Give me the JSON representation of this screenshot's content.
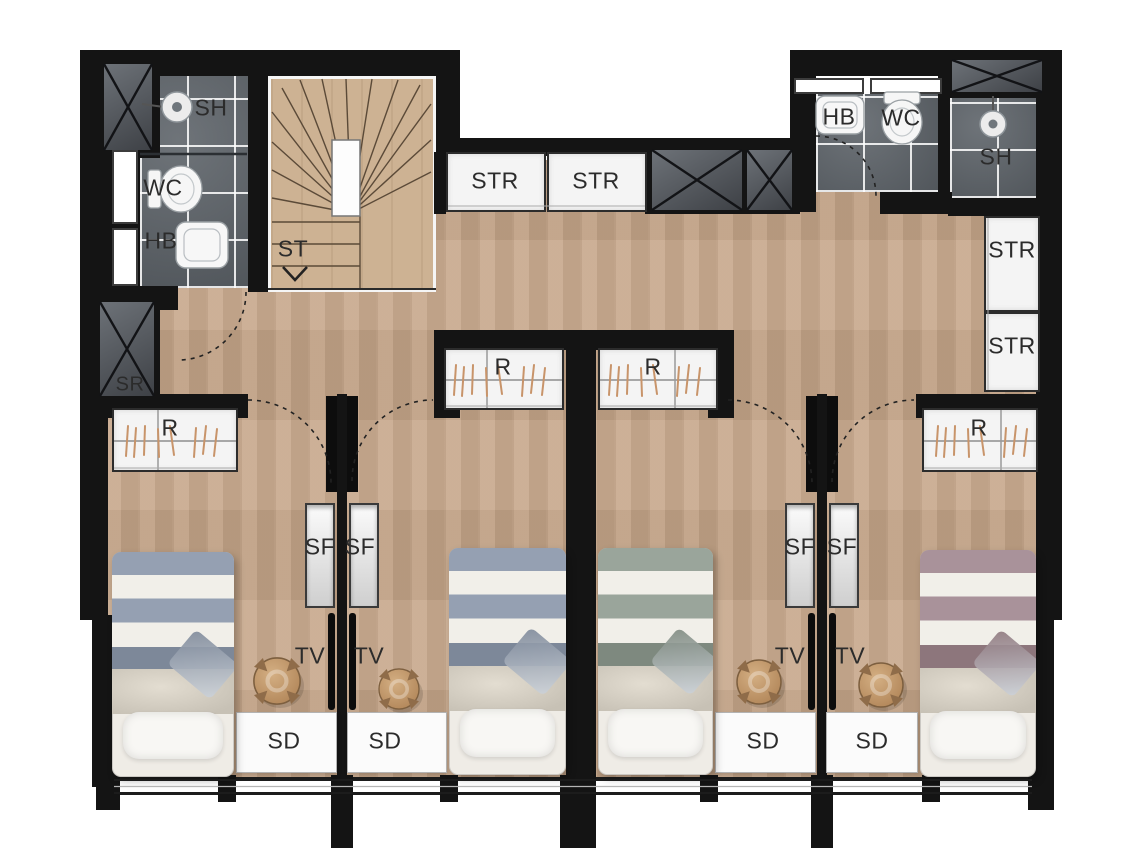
{
  "plan": {
    "bath_left": {
      "shower_label": "SH",
      "wc_label": "WC",
      "basin_label": "HB"
    },
    "bath_right": {
      "basin_label": "HB",
      "wc_label": "WC",
      "shower_label": "SH"
    },
    "stair_label": "ST",
    "riser_label": "SR",
    "storage_top": [
      "STR",
      "STR"
    ],
    "storage_right": [
      "STR",
      "STR"
    ],
    "wardrobe_labels": [
      "R",
      "R",
      "R",
      "R"
    ],
    "shelf_labels": [
      "SF",
      "SF",
      "SF",
      "SF"
    ],
    "tv_labels": [
      "TV",
      "TV",
      "TV",
      "TV"
    ],
    "desk_labels": [
      "SD",
      "SD",
      "SD",
      "SD"
    ],
    "colors": {
      "wall": "#141414",
      "wood_floor": "#c6a689",
      "stair_wood": "#cdb293",
      "bathroom_tile": "#5e646a",
      "unit_white": "#f4f4f4",
      "hanger_tan": "#c8946a",
      "bed_stripe_blue": "#95a0b2",
      "bed_stripe_sage": "#9aa59b",
      "bed_stripe_mauve": "#a9929a",
      "stool_tan": "#c59a6b"
    }
  }
}
